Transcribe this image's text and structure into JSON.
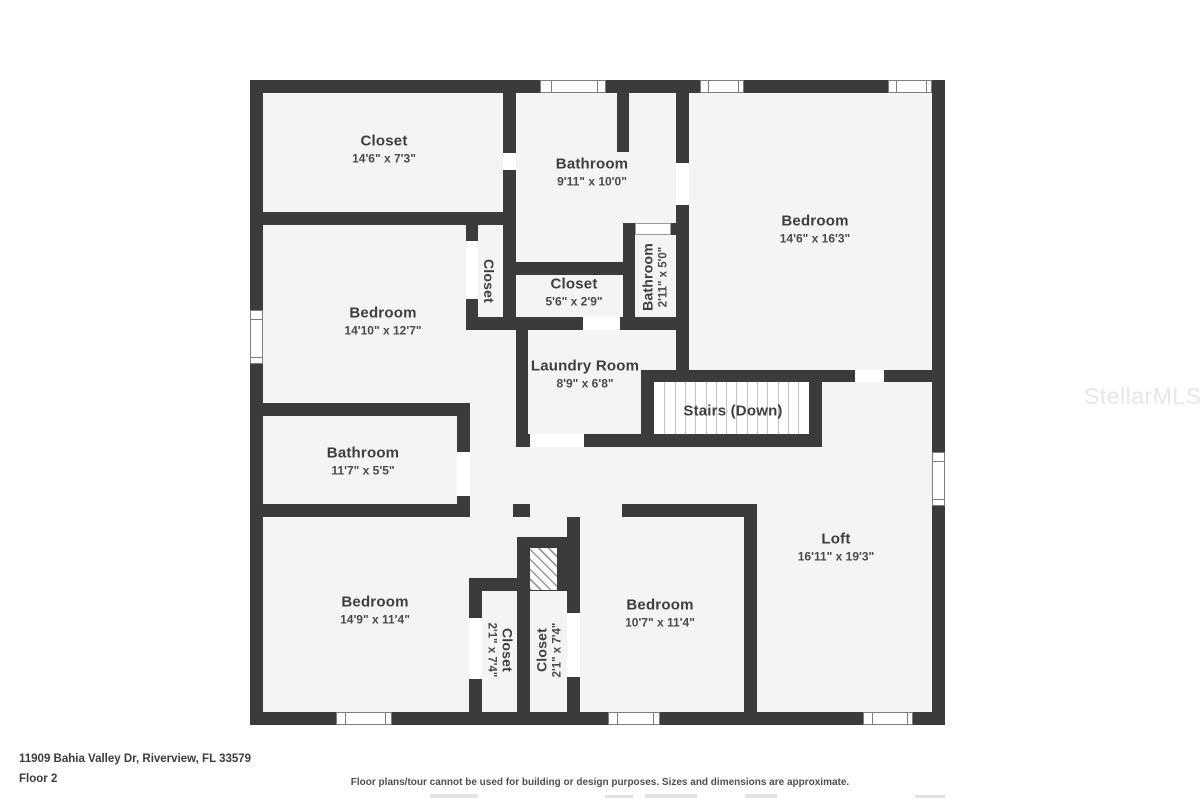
{
  "watermark": "StellarMLS",
  "footer": {
    "address": "11909 Bahia Valley Dr, Riverview, FL 33579",
    "floor_label": "Floor 2",
    "disclaimer": "Floor plans/tour cannot be used for building or design purposes. Sizes and dimensions are approximate."
  },
  "colors": {
    "wall": "#3b3b3b",
    "floor": "#f4f4f4",
    "label_text": "#3e3e3e",
    "watermark_text": "#e7e7e7"
  },
  "rooms": {
    "closet_top": {
      "name": "Closet",
      "dims": "14'6\" x 7'3\""
    },
    "bathroom_top": {
      "name": "Bathroom",
      "dims": "9'11\" x 10'0\""
    },
    "bedroom_top_right": {
      "name": "Bedroom",
      "dims": "14'6\" x 16'3\""
    },
    "closet_hall": {
      "name": "Closet"
    },
    "closet_center": {
      "name": "Closet",
      "dims": "5'6\" x 2'9\""
    },
    "bathroom_small": {
      "name": "Bathroom",
      "dims": "2'11\" x 5'0\""
    },
    "bedroom_mid_left": {
      "name": "Bedroom",
      "dims": "14'10\" x 12'7\""
    },
    "laundry": {
      "name": "Laundry Room",
      "dims": "8'9\" x 6'8\""
    },
    "stairs": {
      "name": "Stairs (Down)"
    },
    "bathroom_mid_left": {
      "name": "Bathroom",
      "dims": "11'7\" x 5'5\""
    },
    "bedroom_bottom_left": {
      "name": "Bedroom",
      "dims": "14'9\" x 11'4\""
    },
    "closet_bottom_left": {
      "name": "Closet",
      "dims": "2'1\" x 7'4\""
    },
    "closet_bottom_right": {
      "name": "Closet",
      "dims": "2'1\" x 7'4\""
    },
    "bedroom_bottom_mid": {
      "name": "Bedroom",
      "dims": "10'7\" x 11'4\""
    },
    "loft": {
      "name": "Loft",
      "dims": "16'11\" x 19'3\""
    }
  }
}
